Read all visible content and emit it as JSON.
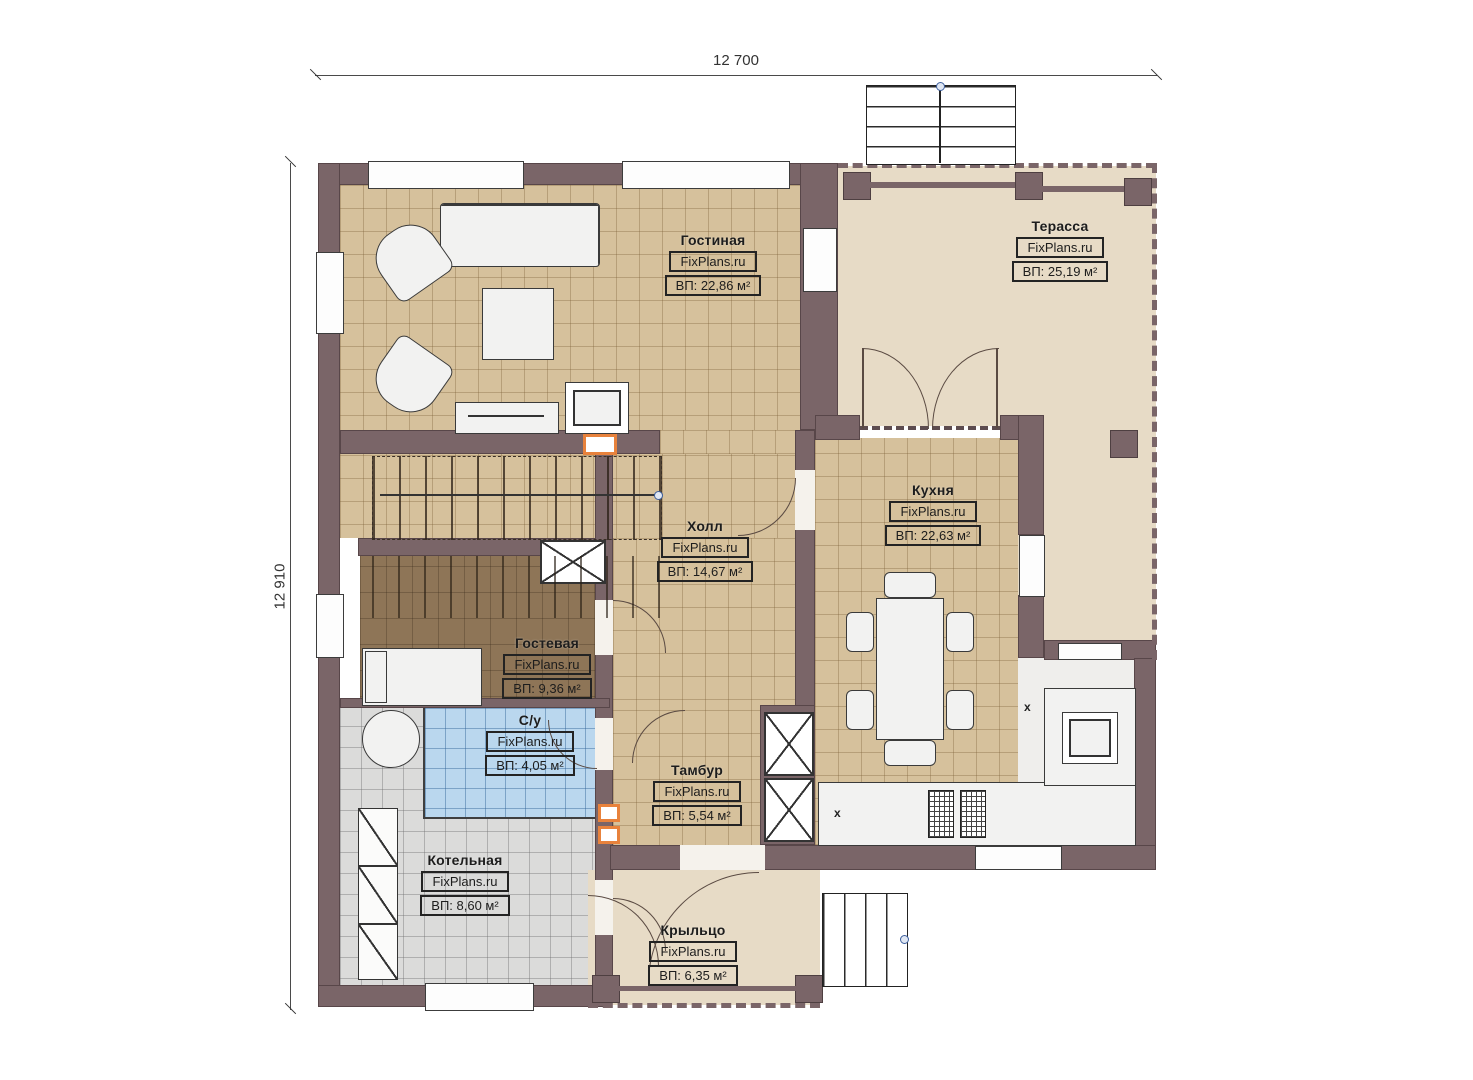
{
  "dimensions": {
    "width": "12 700",
    "height": "12 910"
  },
  "watermark": {
    "text": "FixPlans.ru"
  },
  "rooms": [
    {
      "name": "Гостиная",
      "area": "ВП: 22,86 м²"
    },
    {
      "name": "Терасса",
      "area": "ВП: 25,19 м²"
    },
    {
      "name": "Кухня",
      "area": "ВП: 22,63 м²"
    },
    {
      "name": "Холл",
      "area": "ВП: 14,67 м²"
    },
    {
      "name": "Гостевая",
      "area": "ВП: 9,36 м²"
    },
    {
      "name": "С/у",
      "area": "ВП: 4,05 м²"
    },
    {
      "name": "Тамбур",
      "area": "ВП: 5,54 м²"
    },
    {
      "name": "Котельная",
      "area": "ВП: 8,60 м²"
    },
    {
      "name": "Крыльцо",
      "area": "ВП: 6,35 м²"
    }
  ],
  "annotations": {
    "counter_mark": "x"
  },
  "colors": {
    "wall": "#7a6568",
    "floor_tile": "#d6c19c",
    "terrace": "#e7dbc6",
    "bathroom": "#bad7ee",
    "boiler_room": "#dbdbda",
    "wood_floor": "#8e7557",
    "radiator_accent": "#e8823c"
  }
}
